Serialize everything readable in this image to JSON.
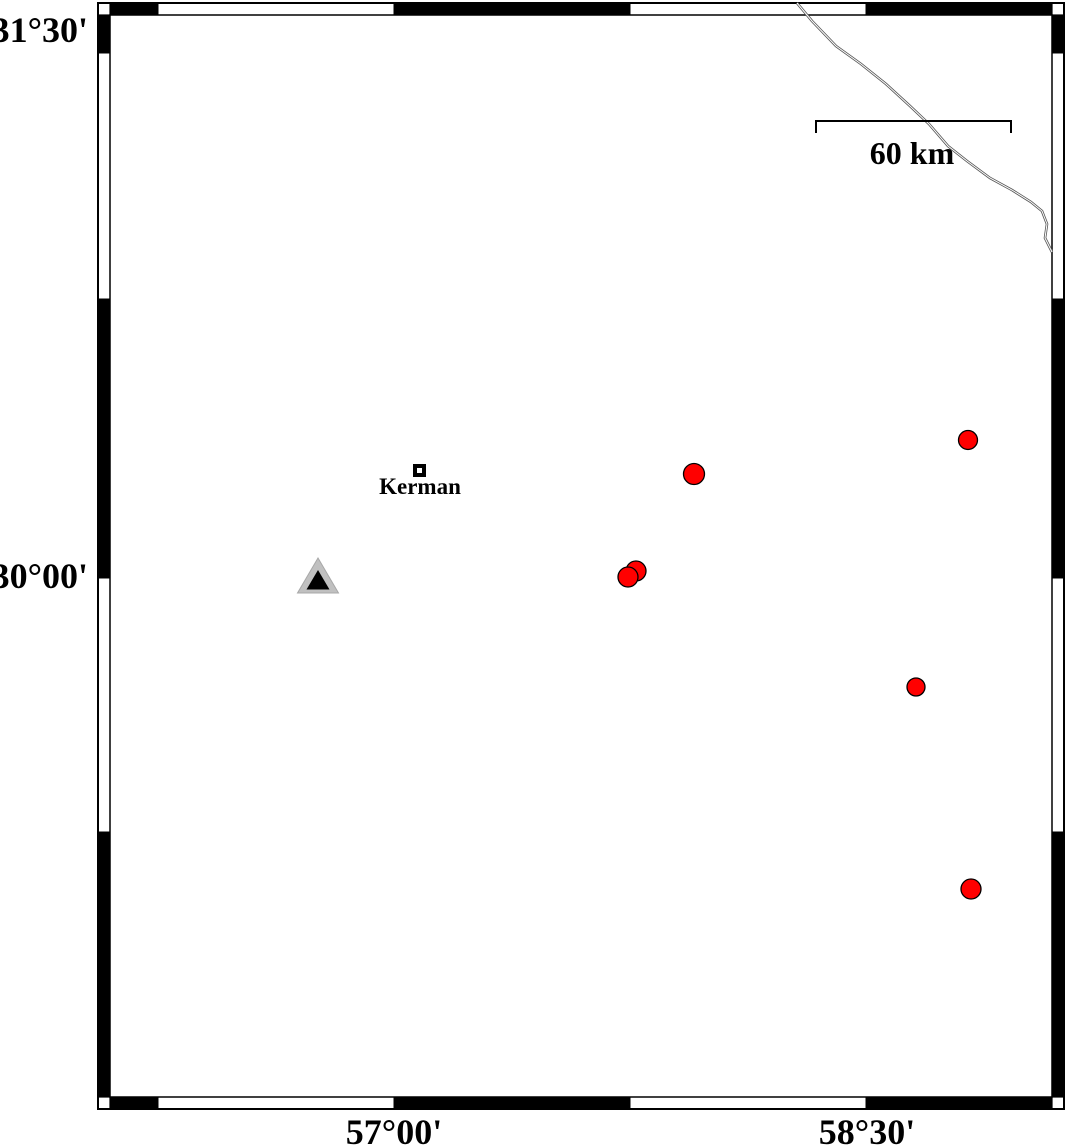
{
  "map": {
    "axis_labels": {
      "lat": [
        {
          "text": "31°30'"
        },
        {
          "text": "30°00'"
        }
      ],
      "lon": [
        {
          "text": "57°00'"
        },
        {
          "text": "58°30'"
        }
      ]
    },
    "scale_bar": {
      "label": "60 km"
    },
    "city": {
      "label": "Kerman"
    }
  },
  "geometry": {
    "frame": {
      "outer": [
        98,
        3,
        1064,
        1109
      ],
      "inner": [
        110,
        15,
        1052,
        1097
      ],
      "lon_boundaries": [
        110,
        158,
        394,
        630,
        866,
        1052
      ],
      "lat_boundaries": [
        15,
        53,
        299,
        578,
        832,
        1097
      ],
      "band_thickness": 12
    },
    "scale_bar": {
      "x1": 816,
      "x2": 1011,
      "y": 121,
      "tick_len": 12
    },
    "city_marker": {
      "x": 413,
      "y": 464,
      "size": 13
    },
    "station": {
      "outer_points": [
        [
          318,
          558
        ],
        [
          297.5,
          593
        ],
        [
          338.5,
          593
        ]
      ],
      "inner_points": [
        [
          318,
          570
        ],
        [
          306.5,
          589.5
        ],
        [
          329.5,
          589.5
        ]
      ]
    },
    "earthquakes": [
      {
        "cx": 694,
        "cy": 474,
        "r": 10.5
      },
      {
        "cx": 968,
        "cy": 440,
        "r": 9.5
      },
      {
        "cx": 636,
        "cy": 571,
        "r": 10
      },
      {
        "cx": 628,
        "cy": 577,
        "r": 10
      },
      {
        "cx": 916,
        "cy": 687,
        "r": 9
      },
      {
        "cx": 971,
        "cy": 889,
        "r": 10
      }
    ],
    "road": [
      [
        797,
        3
      ],
      [
        812,
        21
      ],
      [
        836,
        46
      ],
      [
        861,
        64
      ],
      [
        886,
        84
      ],
      [
        910,
        106
      ],
      [
        929,
        124
      ],
      [
        948,
        146
      ],
      [
        967,
        161
      ],
      [
        990,
        178
      ],
      [
        1012,
        190
      ],
      [
        1031,
        202
      ],
      [
        1042,
        211
      ],
      [
        1047,
        224
      ],
      [
        1045,
        238
      ],
      [
        1052,
        252
      ]
    ]
  },
  "colors": {
    "background": "#ffffff",
    "frame_black": "#000000",
    "earthquake_fill": "#ff0000",
    "marker_outline": "#000000",
    "station_gray": "#c0c0c0",
    "station_edge": "#a8a8a8",
    "road": "#555555"
  }
}
